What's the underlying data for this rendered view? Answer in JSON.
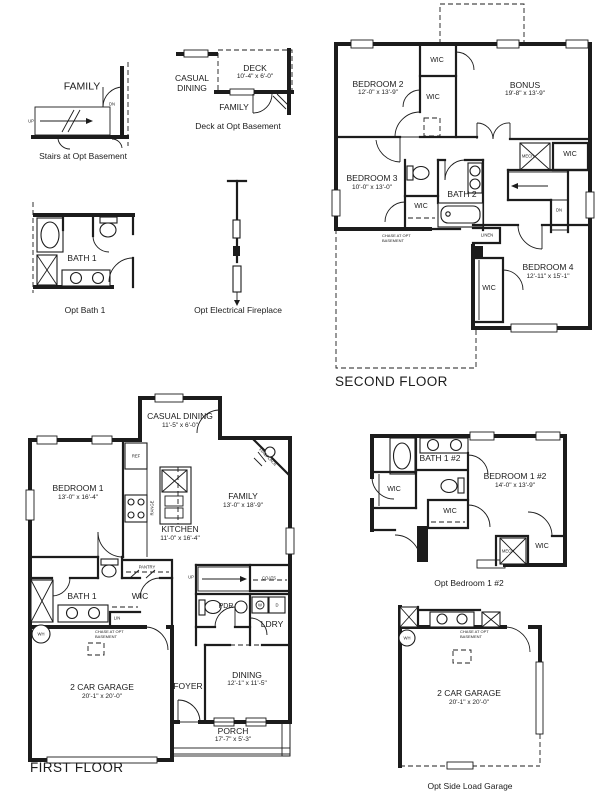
{
  "titles": {
    "first_floor": "FIRST FLOOR",
    "second_floor": "SECOND FLOOR"
  },
  "captions": {
    "stairs_basement": "Stairs at Opt Basement",
    "deck_basement": "Deck at Opt Basement",
    "opt_bath1": "Opt Bath 1",
    "opt_fireplace": "Opt Electrical Fireplace",
    "opt_bedroom1_2": "Opt Bedroom 1 #2",
    "opt_garage": "Opt Side Load Garage"
  },
  "rooms": {
    "family": {
      "name": "FAMILY",
      "dim": "13'-0\" x 18'-9\""
    },
    "deck": {
      "name": "DECK",
      "dim": "10'-4\" x 6'-0\""
    },
    "casual_dining": {
      "name": "CASUAL DINING",
      "name_l1": "CASUAL",
      "name_l2": "DINING",
      "dim": "11'-5\" x 6'-0\""
    },
    "bedroom1": {
      "name": "BEDROOM 1",
      "dim": "13'-0\" x 16'-4\""
    },
    "bedroom2": {
      "name": "BEDROOM 2",
      "dim": "12'-0\" x 13'-9\""
    },
    "bedroom3": {
      "name": "BEDROOM 3",
      "dim": "10'-0\" x 13'-0\""
    },
    "bedroom4": {
      "name": "BEDROOM 4",
      "dim": "12'-11\" x 15'-1\""
    },
    "bedroom1_2": {
      "name": "BEDROOM 1 #2",
      "dim": "14'-0\" x 13'-9\""
    },
    "bonus": {
      "name": "BONUS",
      "dim": "19'-8\" x 13'-9\""
    },
    "kitchen": {
      "name": "KITCHEN",
      "dim": "11'-0\" x 16'-4\""
    },
    "garage": {
      "name": "2 CAR GARAGE",
      "dim": "20'-1\" x 20'-0\""
    },
    "dining": {
      "name": "DINING",
      "dim": "12'-1\" x 11'-5\""
    },
    "porch": {
      "name": "PORCH",
      "dim": "17'-7\" x 5'-3\""
    },
    "foyer": {
      "name": "FOYER"
    },
    "bath1": {
      "name": "BATH 1"
    },
    "bath2": {
      "name": "BATH 2"
    },
    "bath1_2": {
      "name": "BATH 1 #2"
    }
  },
  "labels": {
    "wic": "WIC",
    "up": "UP",
    "dn": "DN",
    "linen": "LINEN",
    "lin": "LIN",
    "mech": "MECH",
    "ref": "REF",
    "range": "RANGE",
    "pantry": "PANTRY",
    "coats": "COATS",
    "pdr": "PDR",
    "ldry": "LDRY",
    "wh": "WH",
    "washer": "W",
    "dryer": "D",
    "fireplace": "FIREPLACE",
    "chase_l1": "CHASE AT OPT",
    "chase_l2": "BASEMENT"
  }
}
